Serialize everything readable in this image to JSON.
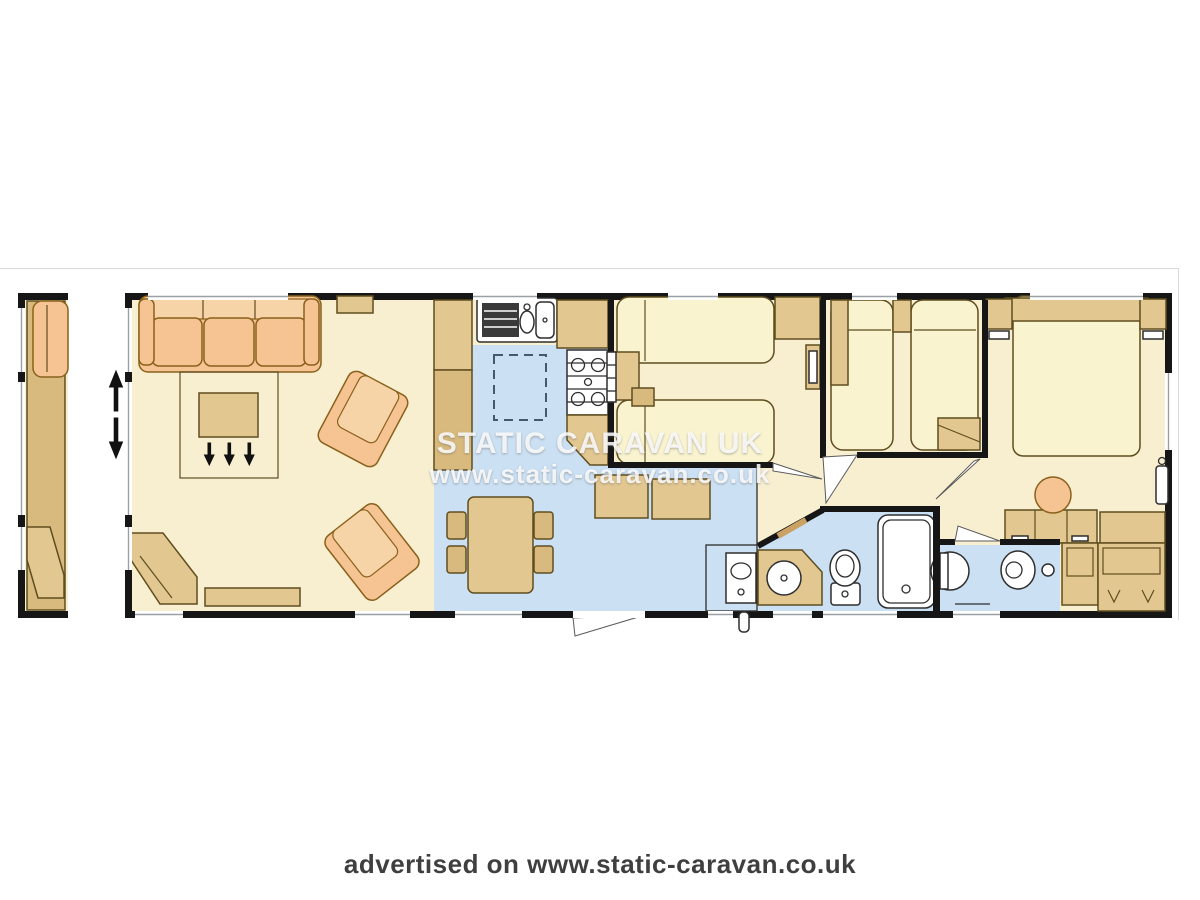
{
  "watermark": {
    "line1": "STATIC CARAVAN UK",
    "line2": "www.static-caravan.co.uk"
  },
  "footer": {
    "text": "advertised on www.static-caravan.co.uk"
  },
  "palette": {
    "wall": "#161616",
    "cream": "#f8efd0",
    "creamlt": "#fcf6da",
    "blue": "#cbe0f3",
    "tan": "#e2c791",
    "tandk": "#d8ba7e",
    "orange": "#f5c492",
    "orangelt": "#f7d3a8",
    "bed": "#f9f3cf",
    "outline": "#5f4d1f",
    "oroutline": "#8a611c",
    "sill": "#9aa0a6",
    "frame": "#d9d9d9",
    "wmcolor": "rgba(255,255,255,0.85)",
    "footercolor": "#3f3f3f"
  },
  "icons": {
    "expand_arrow": "vertical-double-arrow",
    "heat_arrows": "three-down-arrows"
  }
}
